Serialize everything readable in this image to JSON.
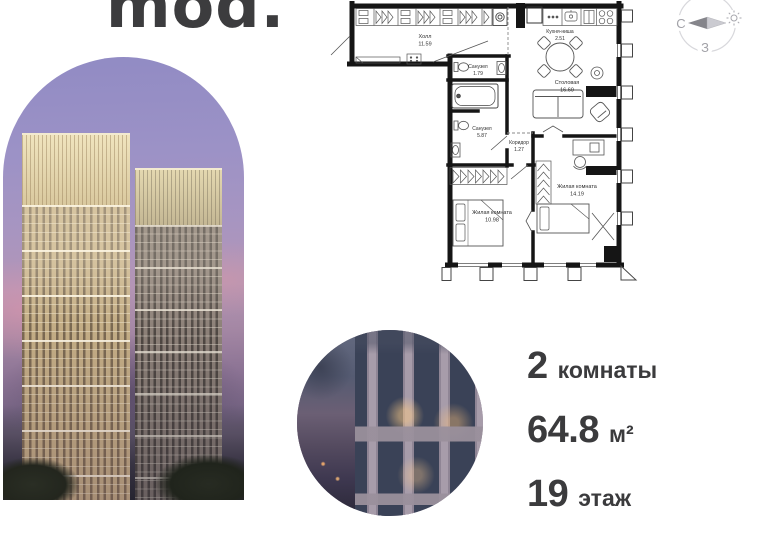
{
  "brand": {
    "logo_text": "mod."
  },
  "compass": {
    "north_label": "С",
    "west_label": "З"
  },
  "floorplan": {
    "rooms": [
      {
        "name": "Холл",
        "area": "11.59"
      },
      {
        "name": "Кухня-ниша",
        "area": "2.51"
      },
      {
        "name": "Столовая",
        "area": "16.69"
      },
      {
        "name": "Санузел",
        "area": "1.79"
      },
      {
        "name": "Санузел",
        "area": "5.87"
      },
      {
        "name": "Коридор",
        "area": "1.27"
      },
      {
        "name": "Жилая комната",
        "area": "14.19"
      },
      {
        "name": "Жилая комната",
        "area": "10.98"
      }
    ]
  },
  "specs": {
    "rooms": {
      "value": "2",
      "label": "комнаты"
    },
    "area": {
      "value": "64.8",
      "unit": "м²"
    },
    "floor": {
      "value": "19",
      "label": "этаж"
    }
  },
  "colors": {
    "text": "#3b3b3d",
    "plan_walls": "#151515",
    "sky_top": "#918bc4",
    "tower_gold": "#c4ae86"
  }
}
